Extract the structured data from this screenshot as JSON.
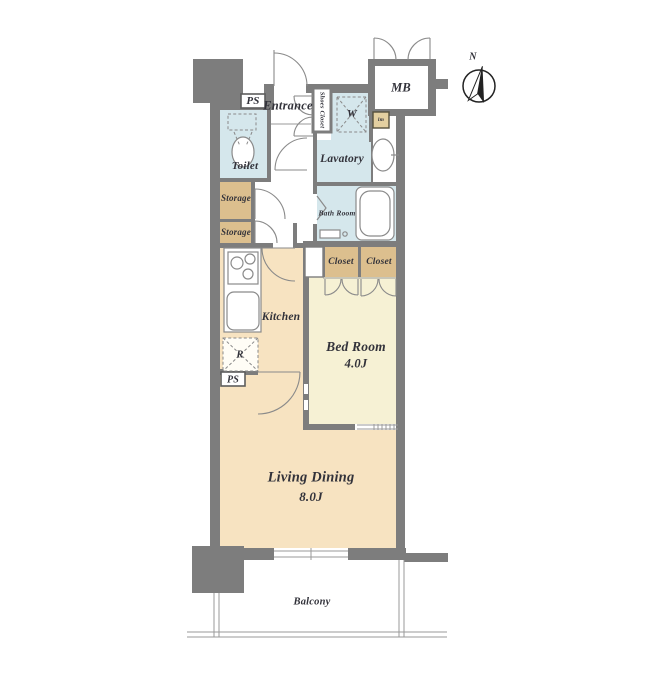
{
  "colors": {
    "wall": "#7d7d7d",
    "cream": "#f7e3c1",
    "bedroom": "#f6f1d4",
    "wet": "#d5e7ec",
    "tan": "#dcbf8e",
    "line": "#9a9a9a",
    "fixline": "#8a8a8a",
    "text": "#32323a"
  },
  "rooms": {
    "pipe_space_top": {
      "label": "PS"
    },
    "entrance": {
      "label": "Entrance"
    },
    "shoes_closet": {
      "label": "Shoes Closet"
    },
    "washer": {
      "label": "W"
    },
    "meter_box": {
      "label": "MB"
    },
    "water_heater": {
      "label": "lm"
    },
    "toilet": {
      "label": "Toilet"
    },
    "lavatory": {
      "label": "Lavatory"
    },
    "bath_room": {
      "label": "Bath Room"
    },
    "storage_upper": {
      "label": "Storage"
    },
    "storage_lower": {
      "label": "Storage"
    },
    "closet_left": {
      "label": "Closet"
    },
    "closet_right": {
      "label": "Closet"
    },
    "kitchen": {
      "label": "Kitchen"
    },
    "refrigerator": {
      "label": "R"
    },
    "pipe_space_bottom": {
      "label": "PS"
    },
    "bed_room": {
      "label": "Bed Room",
      "size": "4.0J"
    },
    "living_dining": {
      "label": "Living Dining",
      "size": "8.0J"
    },
    "balcony": {
      "label": "Balcony"
    }
  },
  "compass": {
    "label": "N"
  }
}
